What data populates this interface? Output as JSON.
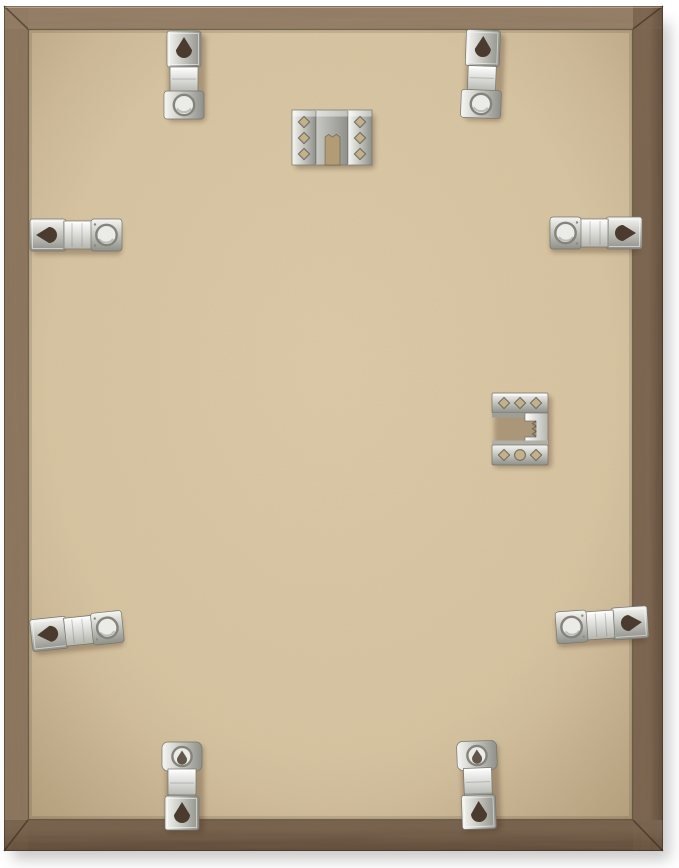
{
  "scene": {
    "type": "product-photo",
    "description": "Back view of a rectangular rustic wooden picture frame with a tan MDF/kraft backing board, eight silver flexible retainer clips around the edges and two silver sawtooth hanger brackets (one top-center for landscape hanging, one right-middle for portrait hanging), on a white background with a soft drop shadow.",
    "background_color": "#ffffff"
  },
  "colors": {
    "bg": "#ffffff",
    "wood_top": "#97816a",
    "wood_left": "#8d7760",
    "wood_right": "#7b6450",
    "wood_right_side": "#5d4a3a",
    "wood_bottom": "#74604c",
    "wood_bottom_side": "#594635",
    "backing_light": "#dccaa8",
    "backing": "#d6c3a0",
    "backing_edge": "#c5b18c",
    "metal_light": "#f6f6f4",
    "metal_mid": "#c9c9c4",
    "metal_dark": "#90908a",
    "metal_edge": "#75756d",
    "spring_light": "#ffffff",
    "spring_dark": "#b5b5af",
    "ring_fill": "#ebebe7",
    "ring_stroke": "#84847c",
    "hole_dark": "#4a3b2e",
    "hole_tan": "#c6b08a",
    "notch_tan": "#b29b75",
    "shadow": "#8a8a8a"
  },
  "hardware": {
    "retainer_clips": [
      {
        "id": "clip-top-left",
        "position": "top edge, left",
        "orientation": "vertical",
        "features": [
          "teardrop-hole",
          "spring-bend",
          "round-eyelet"
        ]
      },
      {
        "id": "clip-top-right",
        "position": "top edge, right",
        "orientation": "vertical",
        "features": [
          "teardrop-hole",
          "spring-bend",
          "round-eyelet"
        ]
      },
      {
        "id": "clip-left-edge",
        "position": "left edge, upper",
        "orientation": "horizontal",
        "features": [
          "teardrop-hole",
          "spring-bend",
          "round-eyelet"
        ]
      },
      {
        "id": "clip-right-edge",
        "position": "right edge, upper",
        "orientation": "horizontal",
        "features": [
          "round-eyelet",
          "spring-bend",
          "teardrop-hole"
        ]
      },
      {
        "id": "clip-bottom-left-edge",
        "position": "left edge, lower",
        "orientation": "horizontal-tilted",
        "features": [
          "teardrop-hole",
          "spring-bend",
          "round-eyelet"
        ]
      },
      {
        "id": "clip-bottom-right-edge",
        "position": "right edge, lower",
        "orientation": "horizontal-tilted",
        "features": [
          "round-eyelet",
          "spring-bend",
          "teardrop-hole"
        ]
      },
      {
        "id": "clip-bottom-left",
        "position": "bottom edge, left",
        "orientation": "vertical",
        "features": [
          "round-eyelet",
          "spring-bend",
          "teardrop-hole"
        ]
      },
      {
        "id": "clip-bottom-right",
        "position": "bottom edge, right",
        "orientation": "vertical",
        "features": [
          "round-eyelet",
          "spring-bend",
          "teardrop-hole"
        ]
      }
    ],
    "hangers": [
      {
        "id": "hanger-top-center",
        "position": "top center",
        "use": "landscape hanging",
        "features": [
          "two flanges with three diamond punch-holes each",
          "central sawtooth notch"
        ]
      },
      {
        "id": "hanger-right-middle",
        "position": "right middle",
        "use": "portrait hanging",
        "features": [
          "two flanges with three punch-holes",
          "C-shaped sawtooth channel opening left"
        ]
      }
    ],
    "material": "silver metal",
    "count_total": 10
  },
  "frame": {
    "material": "weathered wood, mitered corners",
    "backing_material": "tan fiberboard"
  }
}
